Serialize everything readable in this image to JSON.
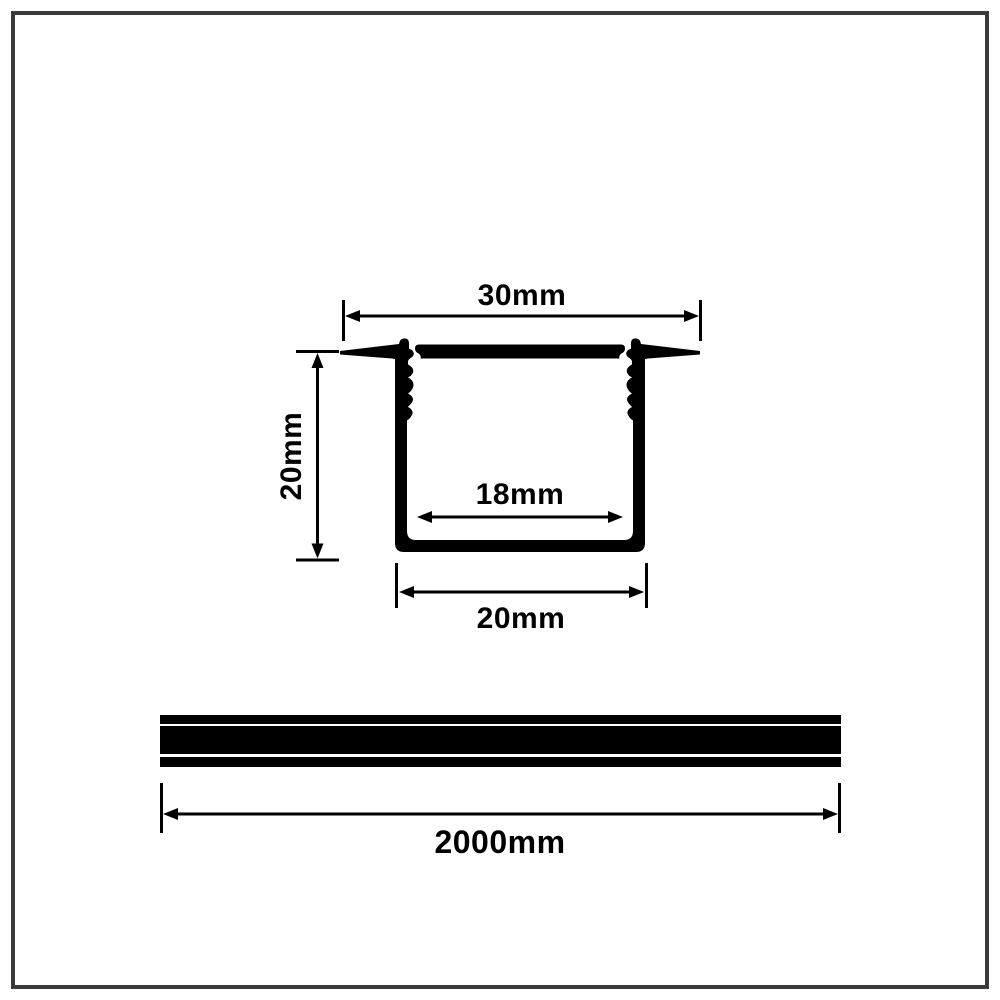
{
  "drawing": {
    "background": "#ffffff",
    "line_color": "#000000",
    "border_color": "#3a3a3a",
    "cross_section": {
      "description": "recessed-led-profile-cross-section",
      "labels": {
        "top_width": "30mm",
        "height": "20mm",
        "inner_width": "18mm",
        "bottom_width": "20mm"
      }
    },
    "side_view": {
      "description": "profile-length-side-view",
      "labels": {
        "length": "2000mm"
      }
    }
  }
}
